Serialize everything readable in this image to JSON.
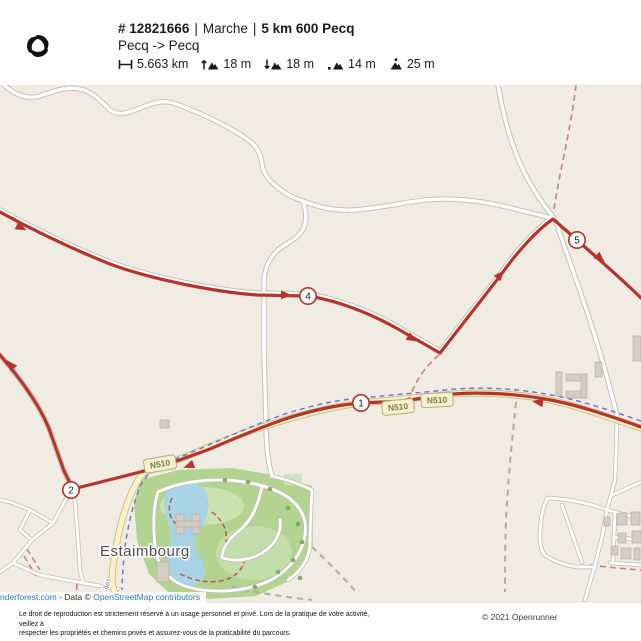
{
  "header": {
    "route_id": "# 12821666",
    "separator": "|",
    "activity": "Marche",
    "route_name": "5 km 600 Pecq",
    "route_direction": "Pecq -> Pecq",
    "stats": [
      {
        "name": "distance",
        "value": "5.663 km"
      },
      {
        "name": "elevation-gain",
        "value": "18 m"
      },
      {
        "name": "elevation-loss",
        "value": "18 m"
      },
      {
        "name": "min-elevation",
        "value": "14 m"
      },
      {
        "name": "max-elevation",
        "value": "25 m"
      }
    ]
  },
  "map": {
    "waypoints": [
      "1",
      "2",
      "4",
      "5"
    ],
    "road_shields": [
      "N510",
      "N510",
      "N510"
    ],
    "place_label": "Estaimbourg",
    "street_label": "llet",
    "attribution": {
      "tiles_link": "nderforest.com",
      "separator": " - Data © ",
      "osm_link": "OpenStreetMap contributors"
    }
  },
  "footer": {
    "legal_line1": "Le droit de reproduction est strictement réservé à un usage personnel et privé. Lors de la pratique de votre activité, veillez à",
    "legal_line2": "respecter les propriétés et chemins privés et assurez-vous de la praticabilité du parcours.",
    "copyright": "© 2021 Openrunner"
  },
  "colors": {
    "route": "#b9332d",
    "primary_road_fill": "#f7f3c6",
    "water": "#a8d4e5",
    "park": "#b3d491",
    "link": "#2e7cc7"
  }
}
